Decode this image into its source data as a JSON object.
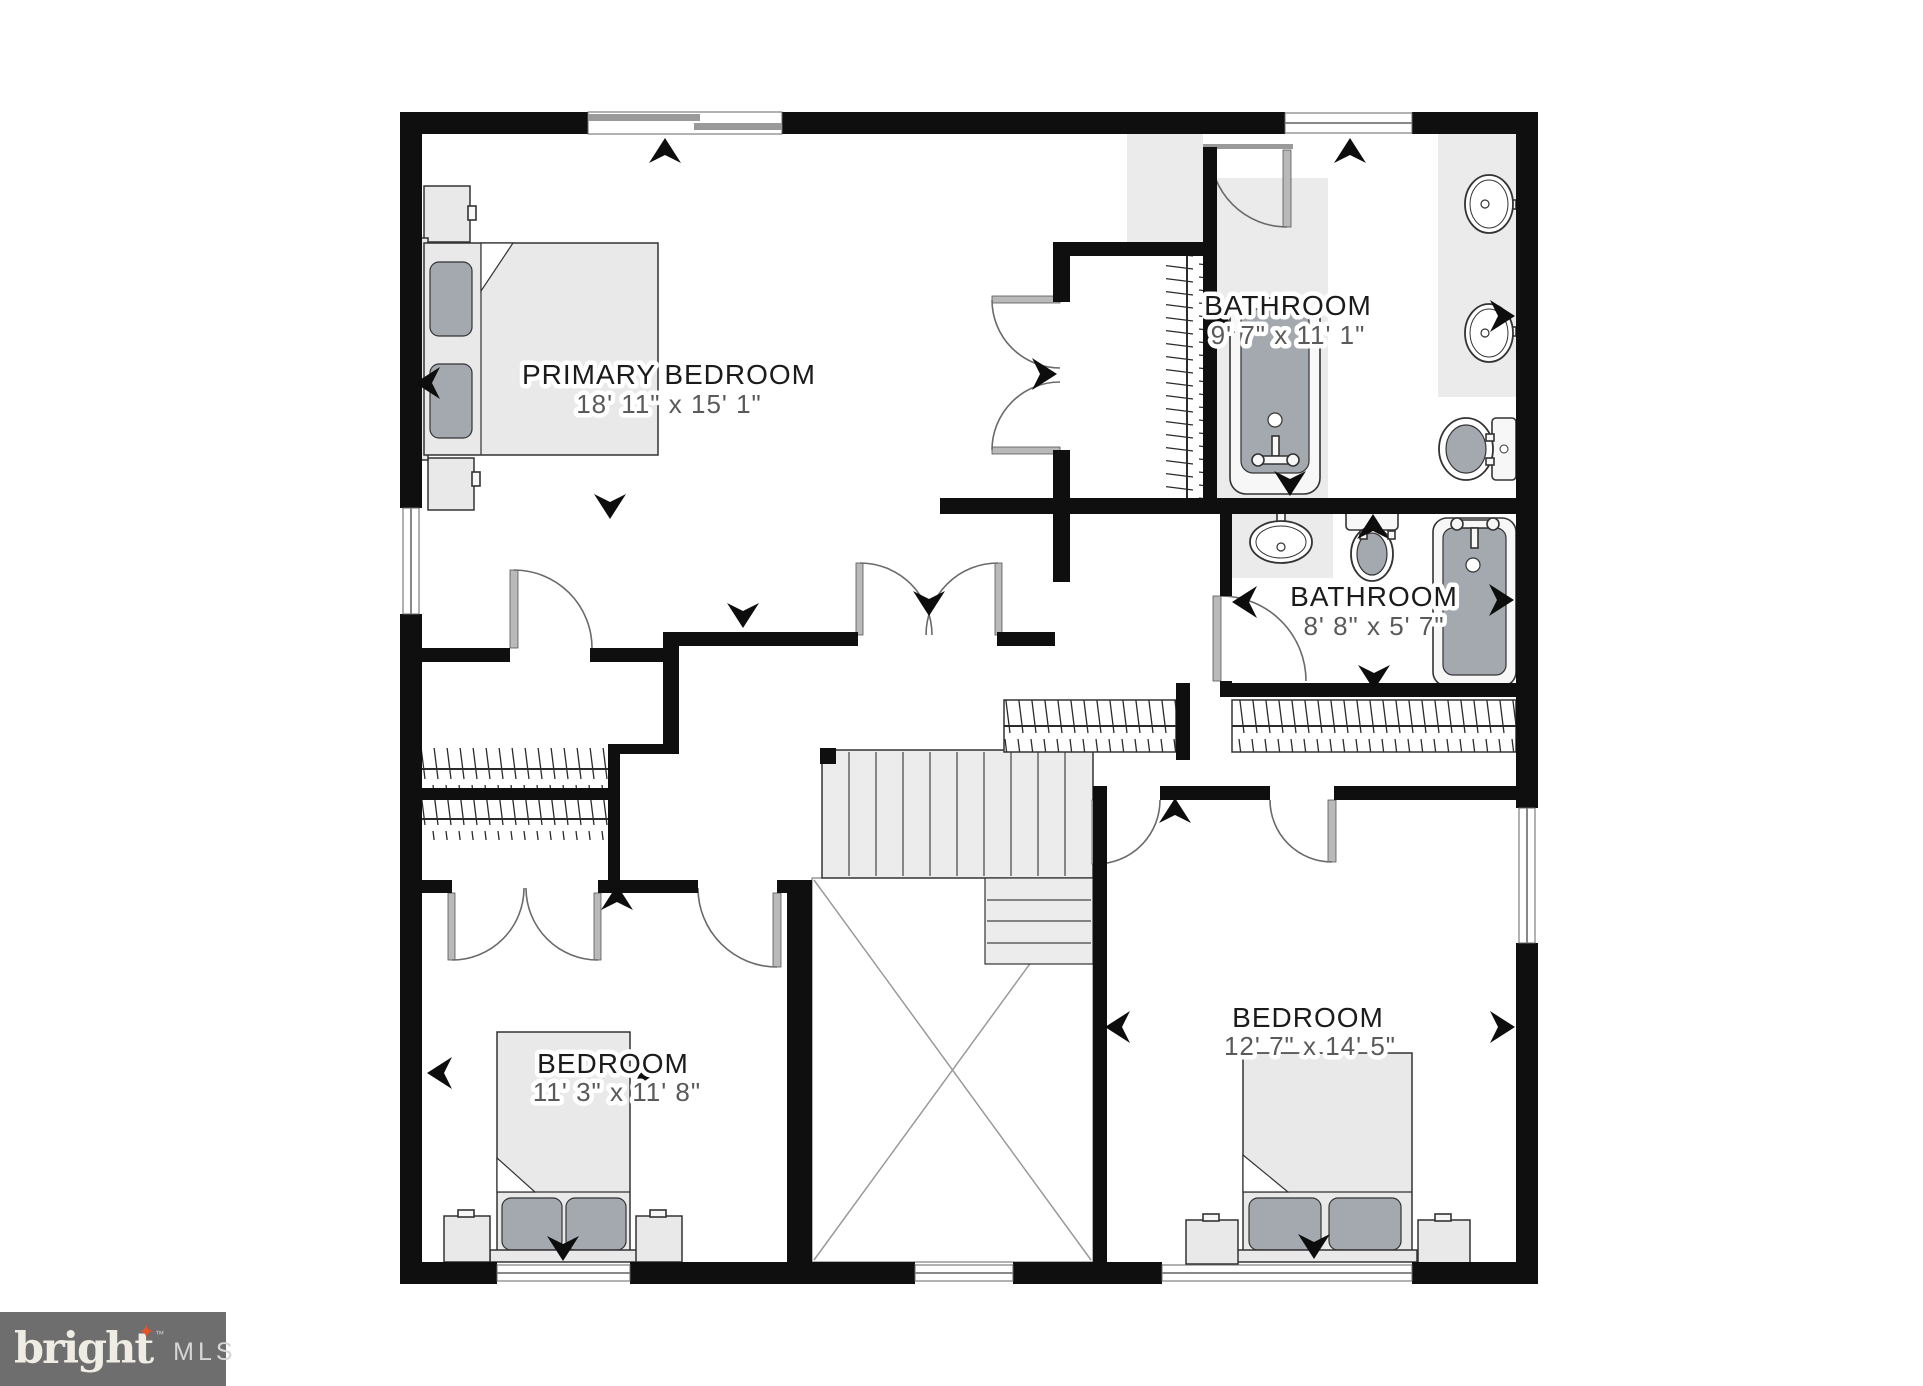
{
  "plan": {
    "type": "residential-floor-plan",
    "rooms": [
      {
        "id": "primary-bedroom",
        "name": "PRIMARY BEDROOM",
        "dims": "18' 11\" x 15' 1\""
      },
      {
        "id": "bathroom-1",
        "name": "BATHROOM",
        "dims": "9' 7\" x 11' 1\""
      },
      {
        "id": "bathroom-2",
        "name": "BATHROOM",
        "dims": "8' 8\" x 5' 7\""
      },
      {
        "id": "bedroom-1",
        "name": "BEDROOM",
        "dims": "11' 3\" x 11' 8\""
      },
      {
        "id": "bedroom-2",
        "name": "BEDROOM",
        "dims": "12' 7\" x 14' 5\""
      }
    ],
    "fixtures": [
      "bed",
      "nightstand",
      "bathtub",
      "sink",
      "toilet",
      "closet-rail",
      "staircase",
      "stairwell-void"
    ],
    "colors": {
      "wall": "#0f0f0f",
      "furniture": "#e9e9e9",
      "fixture_dark": "#a4a9af",
      "floor_mat": "#ebebeb",
      "label_text": "#1b1b1b",
      "dims_text": "#5a5a5a",
      "logo_bg": "#6e6e6e",
      "logo_star": "#e8542a"
    },
    "arrows": [
      {
        "x": 665,
        "y": 152,
        "dir": "up"
      },
      {
        "x": 1350,
        "y": 152,
        "dir": "up"
      },
      {
        "x": 429,
        "y": 383,
        "dir": "left"
      },
      {
        "x": 610,
        "y": 505,
        "dir": "down"
      },
      {
        "x": 1043,
        "y": 374,
        "dir": "right"
      },
      {
        "x": 743,
        "y": 614,
        "dir": "down"
      },
      {
        "x": 1224,
        "y": 317,
        "dir": "left"
      },
      {
        "x": 1501,
        "y": 316,
        "dir": "right"
      },
      {
        "x": 1290,
        "y": 482,
        "dir": "down"
      },
      {
        "x": 1373,
        "y": 528,
        "dir": "up"
      },
      {
        "x": 1246,
        "y": 602,
        "dir": "left"
      },
      {
        "x": 1500,
        "y": 600,
        "dir": "right"
      },
      {
        "x": 1374,
        "y": 676,
        "dir": "down"
      },
      {
        "x": 929,
        "y": 602,
        "dir": "down"
      },
      {
        "x": 617,
        "y": 899,
        "dir": "up"
      },
      {
        "x": 1175,
        "y": 812,
        "dir": "up"
      },
      {
        "x": 441,
        "y": 1073,
        "dir": "left"
      },
      {
        "x": 643,
        "y": 1073,
        "dir": "right"
      },
      {
        "x": 563,
        "y": 1247,
        "dir": "down"
      },
      {
        "x": 1119,
        "y": 1027,
        "dir": "left"
      },
      {
        "x": 1501,
        "y": 1027,
        "dir": "right"
      },
      {
        "x": 1314,
        "y": 1245,
        "dir": "down"
      }
    ]
  },
  "logo": {
    "brand": "bright",
    "tm": "™",
    "star": "✦",
    "suffix": "MLS"
  }
}
